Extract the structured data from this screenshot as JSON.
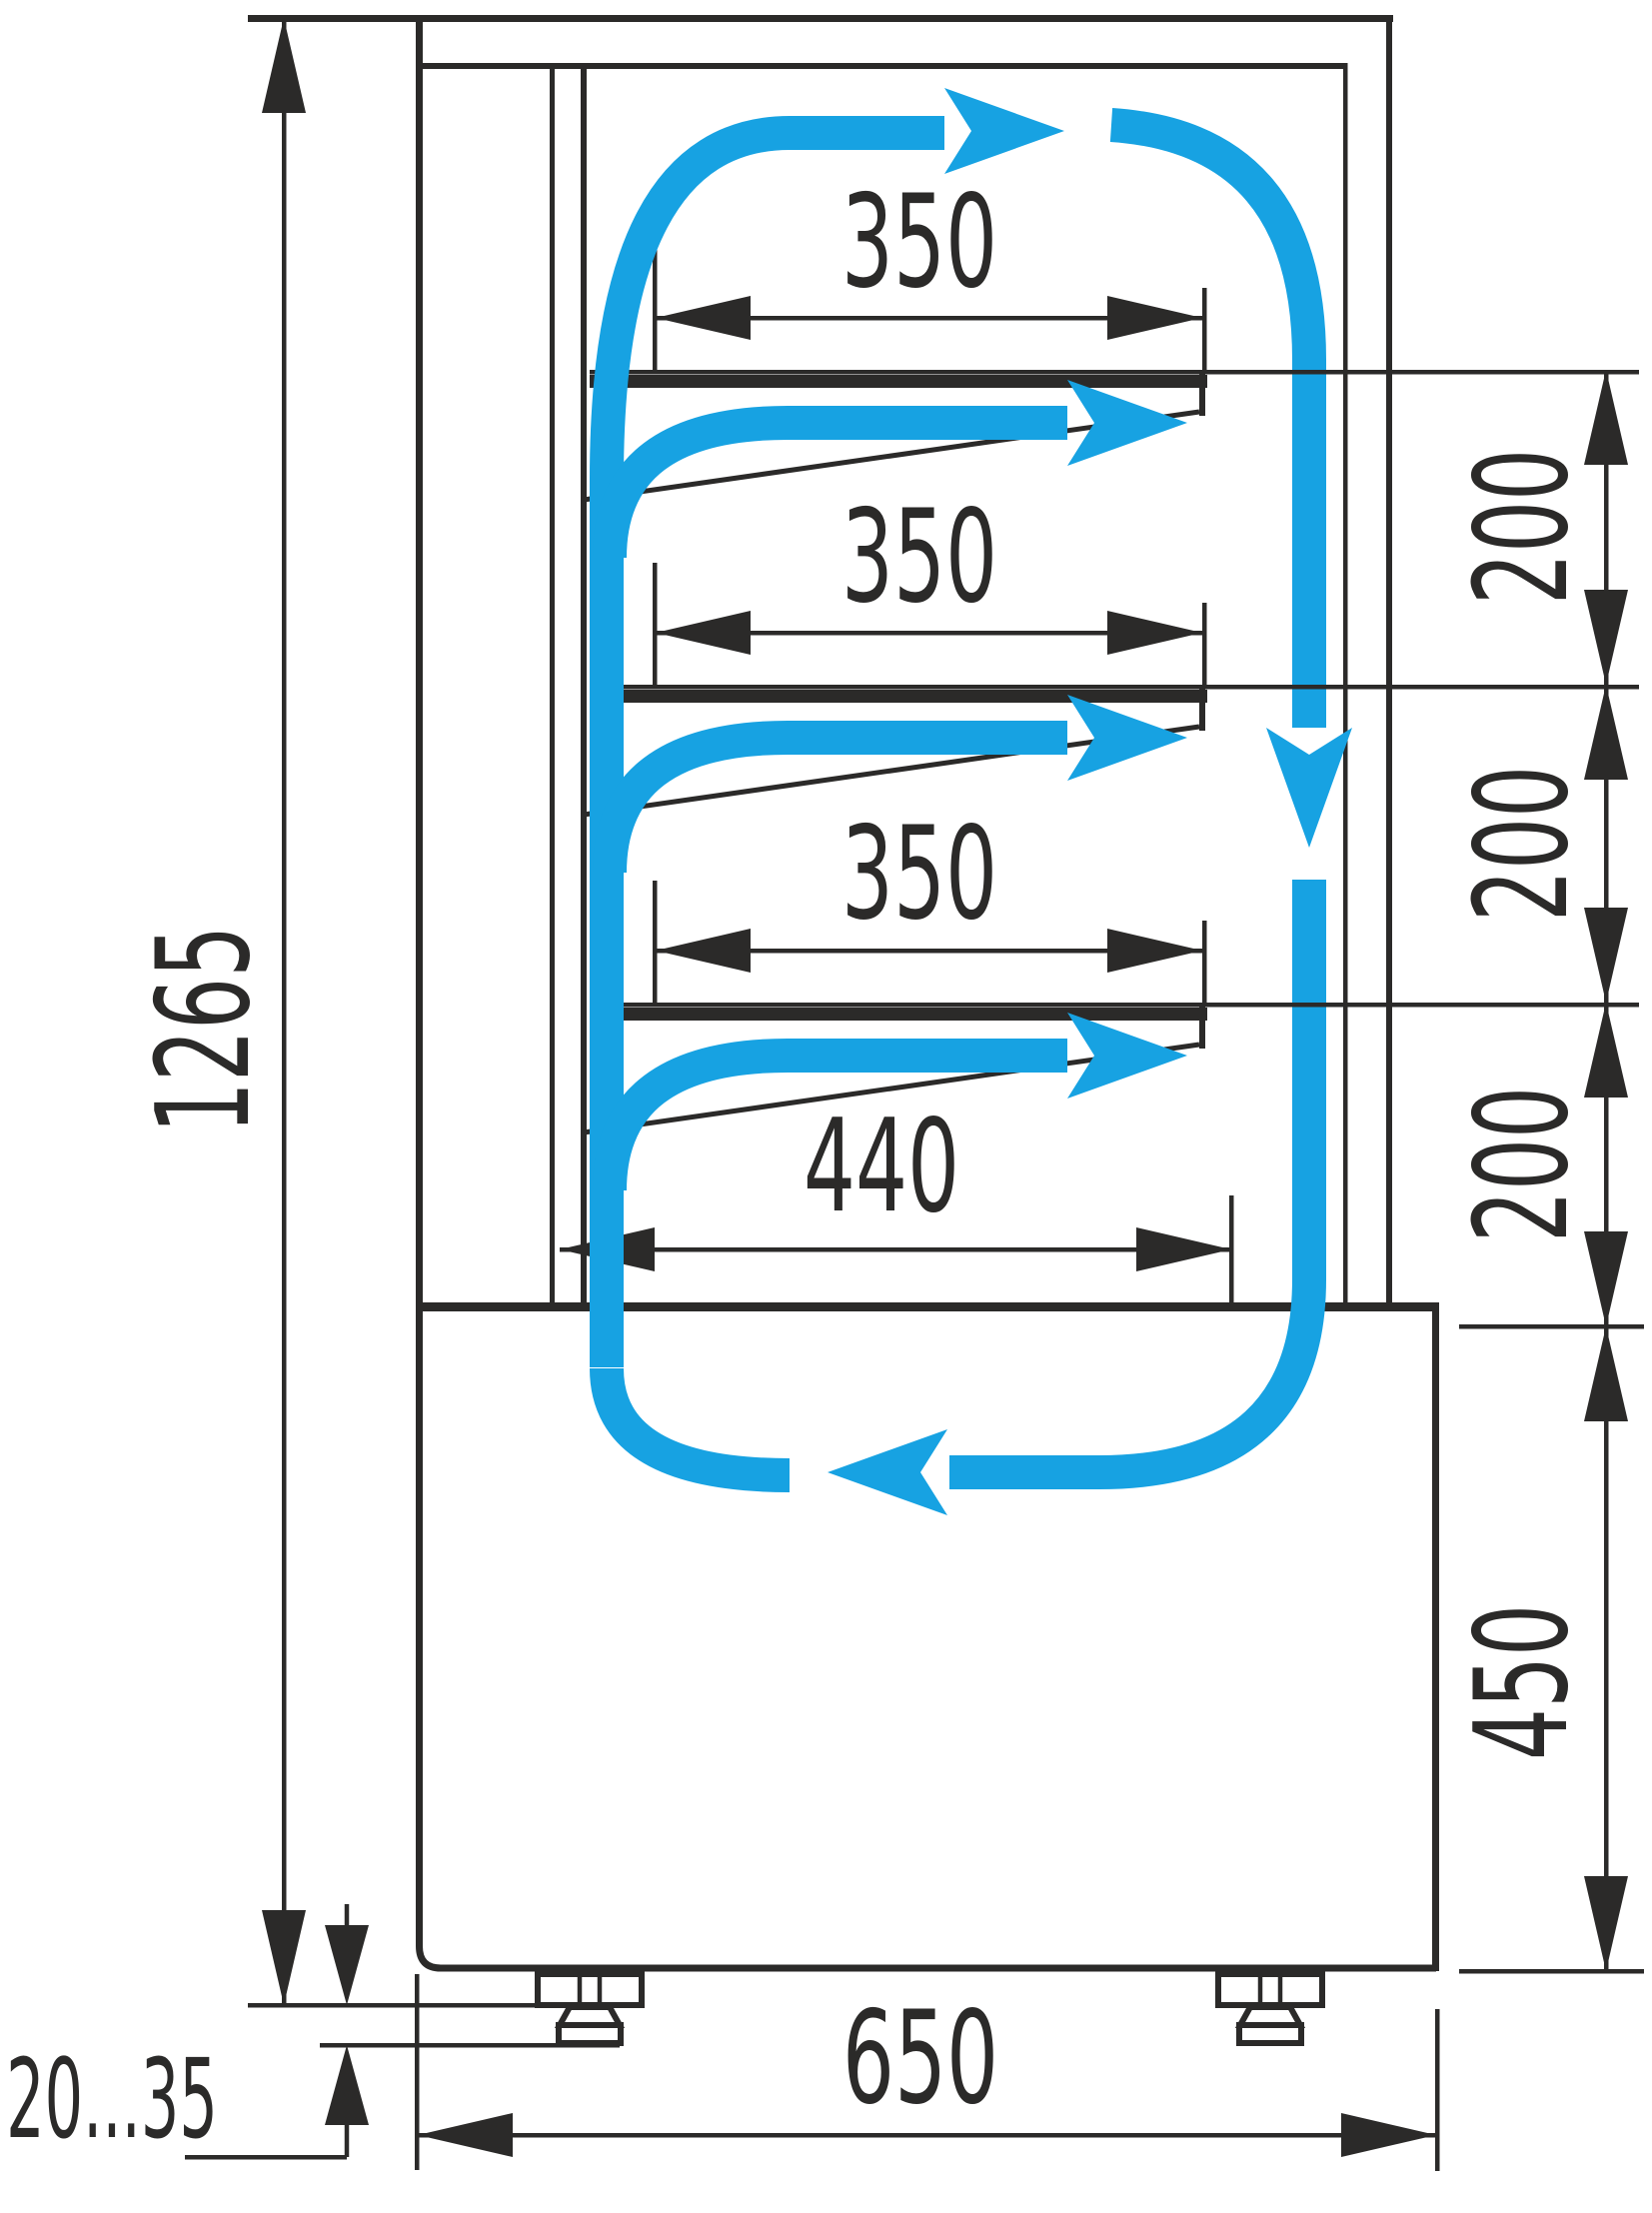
{
  "title": "Refrigerated display case side-section drawing with air circulation and dimensions (mm)",
  "colors": {
    "ink": "#2b2a29",
    "accent": "#17a2e2",
    "paper": "#ffffff"
  },
  "labels": {
    "overall_height": "1265",
    "shelf_top_width": "350",
    "shelf_mid_width": "350",
    "shelf_low_width": "350",
    "floor_width": "440",
    "gap_top": "200",
    "gap_mid": "200",
    "gap_low": "200",
    "base_height": "450",
    "depth": "650",
    "feet_adjust_range": "20...35"
  },
  "legend": {
    "blue_arrows_meaning": "cold air circulation path",
    "units": "mm"
  }
}
